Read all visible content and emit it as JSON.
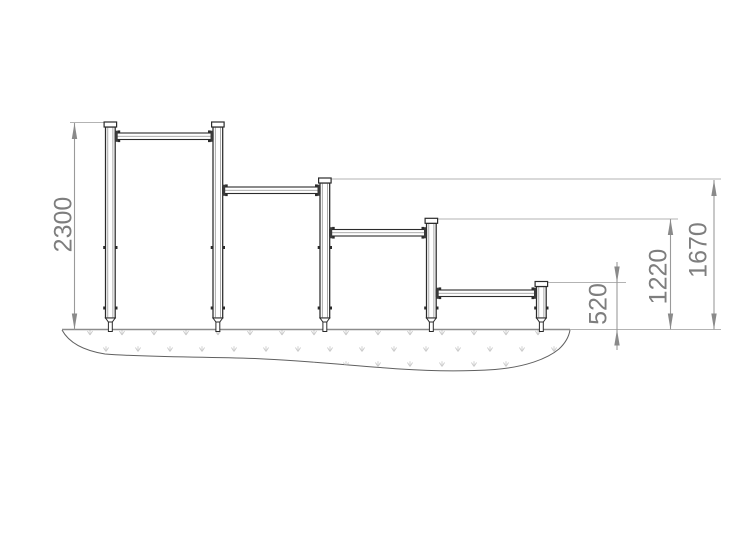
{
  "diagram": {
    "dimensions": [
      {
        "id": "bar-1-height",
        "label": "2300",
        "value_mm": 2300
      },
      {
        "id": "bar-2-height",
        "label": "1670",
        "value_mm": 1670
      },
      {
        "id": "bar-3-height",
        "label": "1220",
        "value_mm": 1220
      },
      {
        "id": "bar-4-height",
        "label": "520",
        "value_mm": 520
      }
    ],
    "colors": {
      "structure": "#2b2b2b",
      "structure_inner": "#8f8f8f",
      "plate": "#3a3a3a",
      "dimension_text": "#7e7e7e",
      "dimension_line": "#9a9a9a",
      "arrow": "#8a8a8a",
      "extension_line": "#b3b3b3",
      "ground_line": "#8c8c8c",
      "ground_outline": "#606060",
      "ground_texture": "#cbcbcb",
      "background": "#ffffff"
    }
  }
}
